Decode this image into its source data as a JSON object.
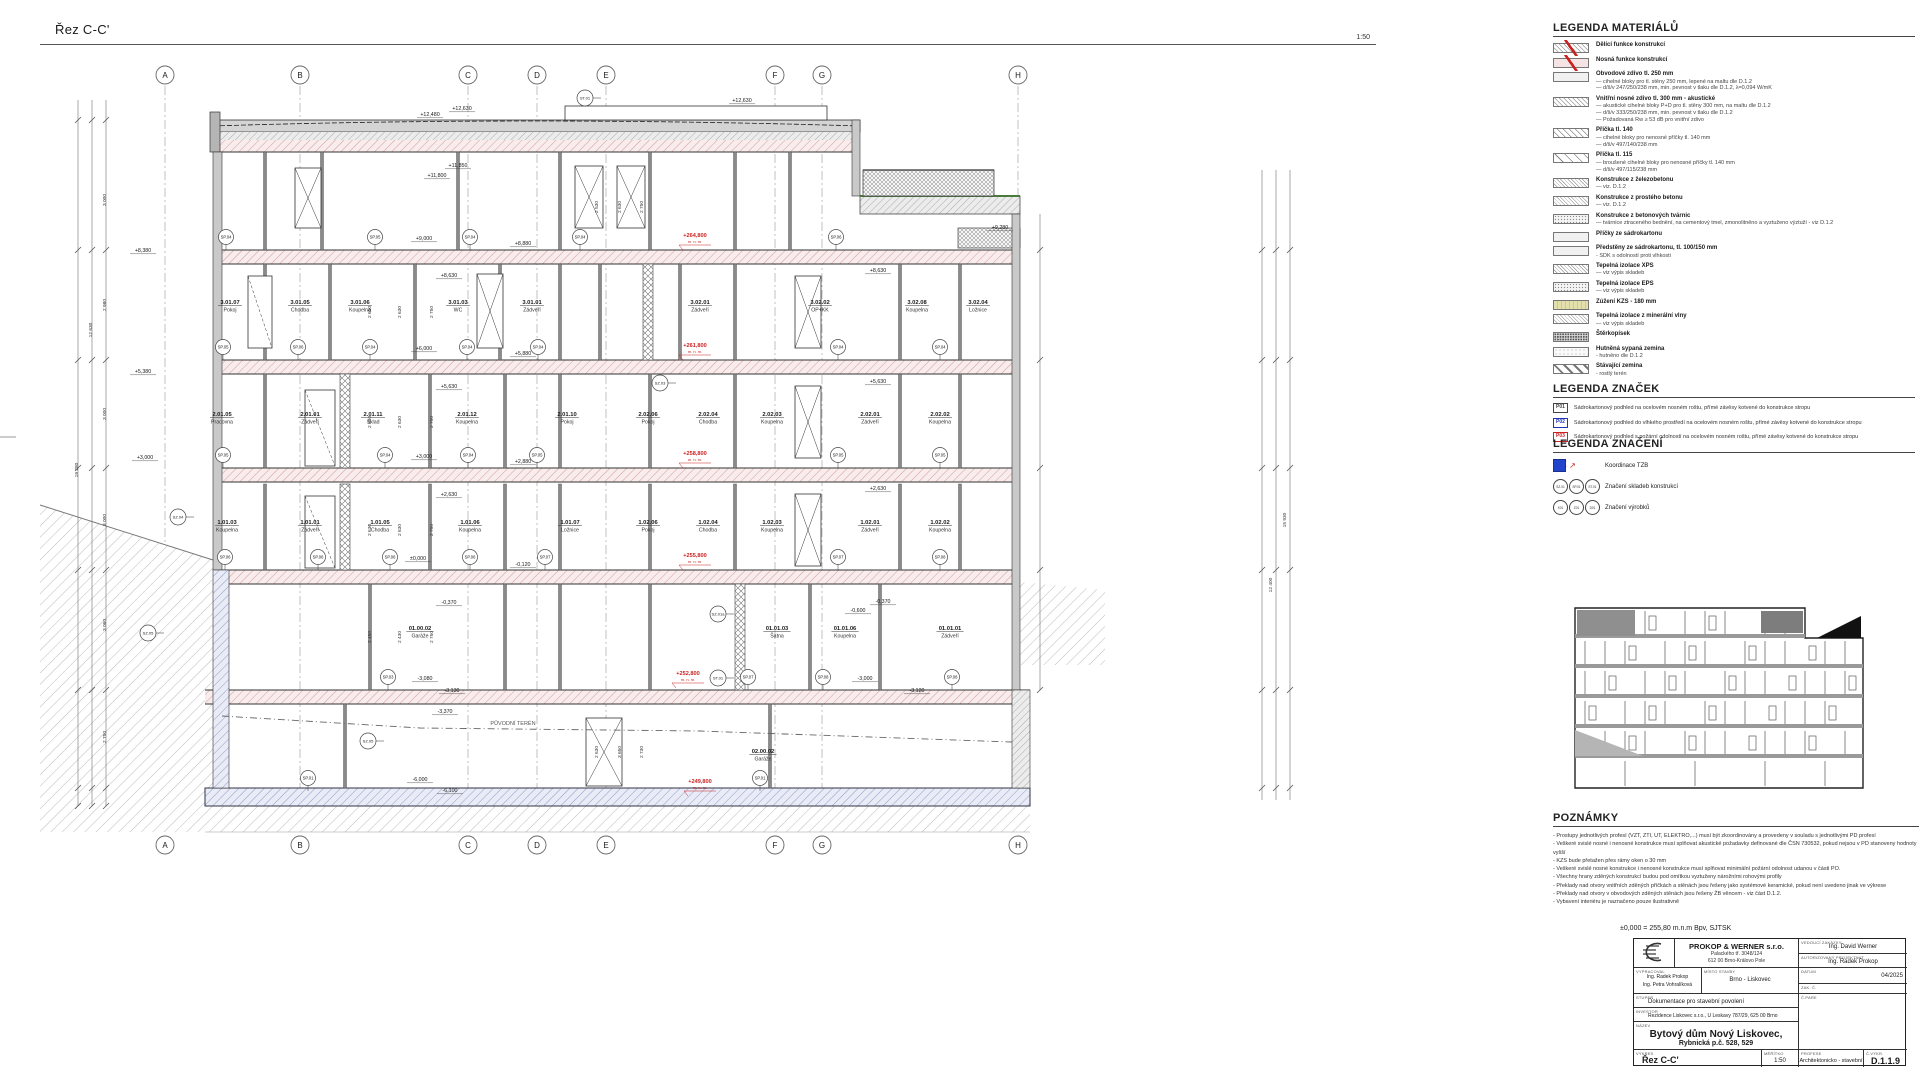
{
  "sheet": {
    "title": "Řez C-C'",
    "scale": "1:50"
  },
  "drawing": {
    "grid": {
      "letters": [
        "A",
        "B",
        "C",
        "D",
        "E",
        "F",
        "G",
        "H"
      ],
      "xs": [
        165,
        300,
        468,
        537,
        606,
        775,
        822,
        1018
      ]
    },
    "terrain_label": "PŮVODNÍ TERÉN",
    "rooms": [
      [
        230,
        304,
        "3.01.07",
        "Pokoj"
      ],
      [
        300,
        304,
        "3.01.05",
        "Chodba"
      ],
      [
        360,
        304,
        "3.01.06",
        "Koupelna"
      ],
      [
        458,
        304,
        "3.01.03",
        "WC"
      ],
      [
        532,
        304,
        "3.01.01",
        "Zádveří"
      ],
      [
        700,
        304,
        "3.02.01",
        "Zádveří"
      ],
      [
        820,
        304,
        "3.02.02",
        "OP+KK"
      ],
      [
        917,
        304,
        "3.02.08",
        "Koupelna"
      ],
      [
        978,
        304,
        "3.02.04",
        "Ložnice"
      ],
      [
        222,
        416,
        "2.01.05",
        "Pracovna"
      ],
      [
        310,
        416,
        "2.01.01",
        "Zádveří"
      ],
      [
        373,
        416,
        "2.01.11",
        "Sklad"
      ],
      [
        467,
        416,
        "2.01.12",
        "Koupelna"
      ],
      [
        567,
        416,
        "2.01.10",
        "Pokoj"
      ],
      [
        648,
        416,
        "2.02.06",
        "Pokoj"
      ],
      [
        708,
        416,
        "2.02.04",
        "Chodba"
      ],
      [
        772,
        416,
        "2.02.03",
        "Koupelna"
      ],
      [
        870,
        416,
        "2.02.01",
        "Zádveří"
      ],
      [
        940,
        416,
        "2.02.02",
        "Koupelna"
      ],
      [
        227,
        524,
        "1.01.03",
        "Koupelna"
      ],
      [
        310,
        524,
        "1.01.01",
        "Zádveří"
      ],
      [
        380,
        524,
        "1.01.05",
        "Chodba"
      ],
      [
        470,
        524,
        "1.01.06",
        "Koupelna"
      ],
      [
        570,
        524,
        "1.01.07",
        "Ložnice"
      ],
      [
        648,
        524,
        "1.02.06",
        "Pokoj"
      ],
      [
        708,
        524,
        "1.02.04",
        "Chodba"
      ],
      [
        772,
        524,
        "1.02.03",
        "Koupelna"
      ],
      [
        870,
        524,
        "1.02.01",
        "Zádveří"
      ],
      [
        940,
        524,
        "1.02.02",
        "Koupelna"
      ],
      [
        420,
        630,
        "01.00.02",
        "Garáže"
      ],
      [
        777,
        630,
        "01.01.03",
        "Šatna"
      ],
      [
        845,
        630,
        "01.01.06",
        "Koupelna"
      ],
      [
        950,
        630,
        "01.01.01",
        "Zádveří"
      ],
      [
        763,
        753,
        "02.00.02",
        "Garáže"
      ]
    ],
    "levels": [
      [
        430,
        116,
        "+12,480"
      ],
      [
        462,
        110,
        "+12,630"
      ],
      [
        742,
        102,
        "+12,630"
      ],
      [
        458,
        167,
        "+11,850"
      ],
      [
        437,
        177,
        "+11,800"
      ],
      [
        1000,
        229,
        "+9,280"
      ],
      [
        424,
        240,
        "+9,000"
      ],
      [
        523,
        245,
        "+8,880"
      ],
      [
        449,
        277,
        "+8,630"
      ],
      [
        878,
        272,
        "+8,630"
      ],
      [
        143,
        252,
        "+8,380"
      ],
      [
        424,
        350,
        "+6,000"
      ],
      [
        523,
        355,
        "+5,880"
      ],
      [
        449,
        388,
        "+5,630"
      ],
      [
        878,
        383,
        "+5,630"
      ],
      [
        143,
        373,
        "+5,380"
      ],
      [
        424,
        458,
        "+3,000"
      ],
      [
        523,
        463,
        "+2,880"
      ],
      [
        449,
        496,
        "+2,630"
      ],
      [
        878,
        490,
        "+2,630"
      ],
      [
        145,
        459,
        "+3,000"
      ],
      [
        418,
        560,
        "±0,000"
      ],
      [
        523,
        566,
        "-0,120"
      ],
      [
        449,
        604,
        "-0,370"
      ],
      [
        883,
        603,
        "-0,370"
      ],
      [
        858,
        612,
        "-0,600"
      ],
      [
        425,
        680,
        "-3,080"
      ],
      [
        452,
        692,
        "-3,130"
      ],
      [
        865,
        680,
        "-3,000"
      ],
      [
        917,
        692,
        "-3,120"
      ],
      [
        445,
        713,
        "-3,370"
      ],
      [
        420,
        781,
        "-6,000"
      ],
      [
        450,
        792,
        "-6,100"
      ]
    ],
    "red_levels": [
      [
        695,
        237,
        "+264,800"
      ],
      [
        695,
        347,
        "+261,800"
      ],
      [
        695,
        455,
        "+258,800"
      ],
      [
        695,
        557,
        "+255,800"
      ],
      [
        688,
        675,
        "+252,800"
      ],
      [
        700,
        783,
        "+249,800"
      ]
    ],
    "red_sub": "m. n. m.",
    "sp_markers": [
      [
        226,
        237,
        "SP.04"
      ],
      [
        375,
        237,
        "SP.05"
      ],
      [
        470,
        237,
        "SP.04"
      ],
      [
        580,
        237,
        "SP.04"
      ],
      [
        836,
        237,
        "SP.06"
      ],
      [
        223,
        347,
        "SP.05"
      ],
      [
        298,
        347,
        "SP.06"
      ],
      [
        370,
        347,
        "SP.04"
      ],
      [
        467,
        347,
        "SP.04"
      ],
      [
        538,
        347,
        "SP.04"
      ],
      [
        838,
        347,
        "SP.04"
      ],
      [
        940,
        347,
        "SP.04"
      ],
      [
        223,
        455,
        "SP.05"
      ],
      [
        385,
        455,
        "SP.04"
      ],
      [
        468,
        455,
        "SP.04"
      ],
      [
        537,
        455,
        "SP.05"
      ],
      [
        838,
        455,
        "SP.05"
      ],
      [
        940,
        455,
        "SP.05"
      ],
      [
        225,
        557,
        "SP.06"
      ],
      [
        318,
        557,
        "SP.06"
      ],
      [
        390,
        557,
        "SP.06"
      ],
      [
        470,
        557,
        "SP.06"
      ],
      [
        545,
        557,
        "SP.07"
      ],
      [
        838,
        557,
        "SP.07"
      ],
      [
        940,
        557,
        "SP.08"
      ],
      [
        388,
        677,
        "SP.03"
      ],
      [
        748,
        677,
        "SP.07"
      ],
      [
        823,
        677,
        "SP.08"
      ],
      [
        952,
        677,
        "SP.08"
      ],
      [
        308,
        778,
        "SP.01"
      ],
      [
        760,
        778,
        "SP.01"
      ]
    ],
    "sz_markers": [
      [
        178,
        517,
        "SZ.04"
      ],
      [
        148,
        633,
        "SZ.05"
      ],
      [
        368,
        741,
        "SZ.05"
      ],
      [
        660,
        383,
        "SZ.03"
      ],
      [
        718,
        614,
        "SZ.01a"
      ],
      [
        718,
        678,
        "ST.01"
      ],
      [
        585,
        98,
        "ST.01"
      ]
    ],
    "dims": [
      [
        371,
        312,
        "2 650"
      ],
      [
        401,
        312,
        "2 630"
      ],
      [
        433,
        312,
        "2 750"
      ],
      [
        371,
        422,
        "2 650"
      ],
      [
        401,
        422,
        "2 630"
      ],
      [
        433,
        422,
        "2 750"
      ],
      [
        371,
        530,
        "2 630"
      ],
      [
        401,
        530,
        "2 630"
      ],
      [
        433,
        530,
        "2 750"
      ],
      [
        371,
        637,
        "2 450"
      ],
      [
        401,
        637,
        "2 430"
      ],
      [
        433,
        637,
        "2 750"
      ],
      [
        598,
        207,
        "2 530"
      ],
      [
        621,
        207,
        "2 630"
      ],
      [
        643,
        207,
        "2 750"
      ],
      [
        598,
        752,
        "2 630"
      ],
      [
        621,
        752,
        "3 650"
      ],
      [
        643,
        752,
        "2 730"
      ],
      [
        106,
        200,
        "3 000"
      ],
      [
        106,
        305,
        "2 980"
      ],
      [
        106,
        414,
        "3 000"
      ],
      [
        106,
        520,
        "3 000"
      ],
      [
        106,
        625,
        "3 060"
      ],
      [
        106,
        737,
        "2 750"
      ],
      [
        92,
        330,
        "12 630"
      ],
      [
        78,
        470,
        "19 280"
      ],
      [
        1272,
        585,
        "12 400"
      ],
      [
        1286,
        520,
        "15 930"
      ]
    ]
  },
  "legend_materials": {
    "title": "LEGENDA MATERIÁLŮ",
    "items": [
      {
        "pattern": "p-cross slash",
        "title": "Dělící funkce konstrukcí",
        "lines": []
      },
      {
        "pattern": "p-pink slash",
        "title": "Nosná funkce konstrukcí",
        "lines": []
      },
      {
        "pattern": "p-plain",
        "title": "Obvodové zdivo tl. 250 mm",
        "lines": [
          "— cihelné bloky pro tl. stěny 250 mm, lepené na maltu dle D.1.2",
          "— d/š/v 247/250/238 mm, min. pevnost v tlaku dle D.1.2, λ=0,094 W/mK"
        ]
      },
      {
        "pattern": "p-cross",
        "title": "Vnitřní nosné zdivo tl. 300 mm - akustické",
        "lines": [
          "— akustické cihelné bloky P+D pro tl. stěny 300 mm, na maltu dle D.1.2",
          "— d/š/v 333/250/238 mm, min. pevnost v tlaku dle D.1.2",
          "— Požadovaná Rw ≥ 53 dB pro vnitřní zdivo"
        ]
      },
      {
        "pattern": "p-diag",
        "title": "Příčka tl. 140",
        "lines": [
          "— cihelné bloky pro nenosné příčky tl. 140 mm",
          "— d/š/v 497/140/238 mm"
        ]
      },
      {
        "pattern": "p-diag2",
        "title": "Příčka tl. 115",
        "lines": [
          "— broušené cihelné bloky pro nenosné příčky tl. 140 mm",
          "— d/š/v 497/115/238 mm"
        ]
      },
      {
        "pattern": "p-diagfine",
        "title": "Konstrukce z železobetonu",
        "lines": [
          "— viz. D.1.2"
        ]
      },
      {
        "pattern": "p-crossfine",
        "title": "Konstrukce z prostého betonu",
        "lines": [
          "— viz. D.1.2"
        ]
      },
      {
        "pattern": "p-dots",
        "title": "Konstrukce z betonových tvárnic",
        "lines": [
          "— tvárnice ztraceného bednění, na cementový tmel, zmonolitněno a vyztuženo výztuží - viz D.1.2"
        ]
      },
      {
        "pattern": "p-plain",
        "title": "Příčky ze sádrokartonu",
        "lines": []
      },
      {
        "pattern": "p-plain",
        "title": "Předstěny ze sádrokartonu, tl. 100/150 mm",
        "lines": [
          "- SDK s odolností proti vlhkosti"
        ]
      },
      {
        "pattern": "p-diagfine",
        "title": "Tepelná izolace XPS",
        "lines": [
          "— viz výpis skladeb"
        ]
      },
      {
        "pattern": "p-dots",
        "title": "Tepelná izolace EPS",
        "lines": [
          "— viz výpis skladeb"
        ]
      },
      {
        "pattern": "p-kzs",
        "title": "Zúžení KZS - 180 mm",
        "lines": []
      },
      {
        "pattern": "p-crossfine",
        "title": "Tepelná izolace z minerální vlny",
        "lines": [
          "— viz výpis skladeb"
        ]
      },
      {
        "pattern": "p-dotsdark",
        "title": "Štěrkopísek",
        "lines": []
      },
      {
        "pattern": "p-dotslight",
        "title": "Hutněná sypaná zemina",
        "lines": [
          "- hutněno dle D.1.2"
        ]
      },
      {
        "pattern": "p-stripes",
        "title": "Stávající zemina",
        "lines": [
          "- rostlý terén"
        ]
      }
    ]
  },
  "legend_marks": {
    "title": "LEGENDA ZNAČEK",
    "items": [
      {
        "code": "P01",
        "color": "#444444",
        "text": "Sádrokartonový podhled na ocelovém nosném roštu, přímé závěsy kotvené do konstrukce stropu"
      },
      {
        "code": "P02",
        "color": "#2233bb",
        "text": "Sádrokartonový podhled do vlhkého prostředí na ocelovém nosném roštu, přímé závěsy kotvené do konstrukce stropu"
      },
      {
        "code": "P03",
        "color": "#cc2222",
        "text": "Sádrokartonový podhled s požární odolností na ocelovém nosném roštu, přímé závěsy kotvené do konstrukce stropu"
      }
    ]
  },
  "legend_symbols": {
    "title": "LEGENDA ZNAČENÍ",
    "items": [
      {
        "icon": "tzb",
        "circles": [],
        "label": "Koordinace TZB"
      },
      {
        "icon": "circles",
        "circles": [
          "SZ.01",
          "SP.01",
          "ST.01"
        ],
        "label": "Značení skladeb konstrukcí"
      },
      {
        "icon": "circles",
        "circles": [
          "X01",
          "Z01",
          "D01"
        ],
        "label": "Značení výrobků"
      }
    ]
  },
  "notes": {
    "title": "POZNÁMKY",
    "lines": [
      "- Prostupy jednotlivých profesí (VZT, ZTI, UT, ELEKTRO,...) musí být zkoordinovány a provedeny v souladu s jednotlivými PD profesí",
      "- Veškeré svislé nosné i nenosné konstrukce musí splňovat akustické požadavky definované dle ČSN 730532, pokud nejsou v PD stanoveny hodnoty vyšší",
      "- KZS bude přetažen přes rámy oken o 30 mm",
      "- Veškeré svislé nosné konstrukce i nenosné konstrukce musí splňovat minimální požární odolnost udanou v části PO.",
      "- Všechny hrany zděných konstrukcí budou pod omítkou vyztuženy nárožními rohovými profily",
      "- Překlady nad otvory vnitřních zděných příčkách a stěnách jsou řešeny jako systémové keramické, pokud není uvedeno jinak ve výkrese",
      "- Překlady nad otvory v obvodových zděných stěnách jsou řešeny ŽB věncem - viz část D.1.2.",
      "- Vybavení interiéru je naznačeno pouze ilustrativně"
    ]
  },
  "titleblock": {
    "datum_note": "±0,000 = 255,80 m.n.m Bpv, SJTSK",
    "firm_name": "PROKOP & WERNER s.r.o.",
    "firm_addr1": "Palackého tř. 3048/124",
    "firm_addr2": "612 00 Brno-Královo Pole",
    "lbl_lead": "VEDOUCÍ ZAKÁZKY",
    "lead": "Ing. David Werner",
    "lbl_auth": "AUTORIZOVANÝ PROJEKTANT",
    "auth": "Ing. Radek Prokop",
    "lbl_made": "VYPRACOVAL",
    "made1": "Ing. Radek Prokop",
    "made2": "Ing. Petra Vohralíková",
    "lbl_place": "MÍSTO STAVBY",
    "place": "Brno - Liskovec",
    "lbl_date": "DATUM",
    "date": "04/2025",
    "lbl_zak": "ZAK. Č.",
    "lbl_stage": "STUPEŇ",
    "stage": "Dokumentace pro stavební povolení",
    "lbl_investor": "INVESTOR",
    "investor": "Rezidence Liskovec s.r.o., U Leskavy 787/29, 625 00 Brno",
    "lbl_name": "NÁZEV",
    "name1": "Bytový dům Nový Liskovec,",
    "name2": "Rybnická p.č. 528, 529",
    "lbl_drawing": "VÝKRES",
    "drawing": "Řez C-C'",
    "lbl_scale": "MĚŘÍTKO",
    "scale": "1:50",
    "lbl_prof": "PROFESE",
    "prof": "Architektonicko - stavební",
    "lbl_no": "Č.VÝKR.",
    "no": "D.1.1.9",
    "lbl_pare": "Č.PARE"
  }
}
